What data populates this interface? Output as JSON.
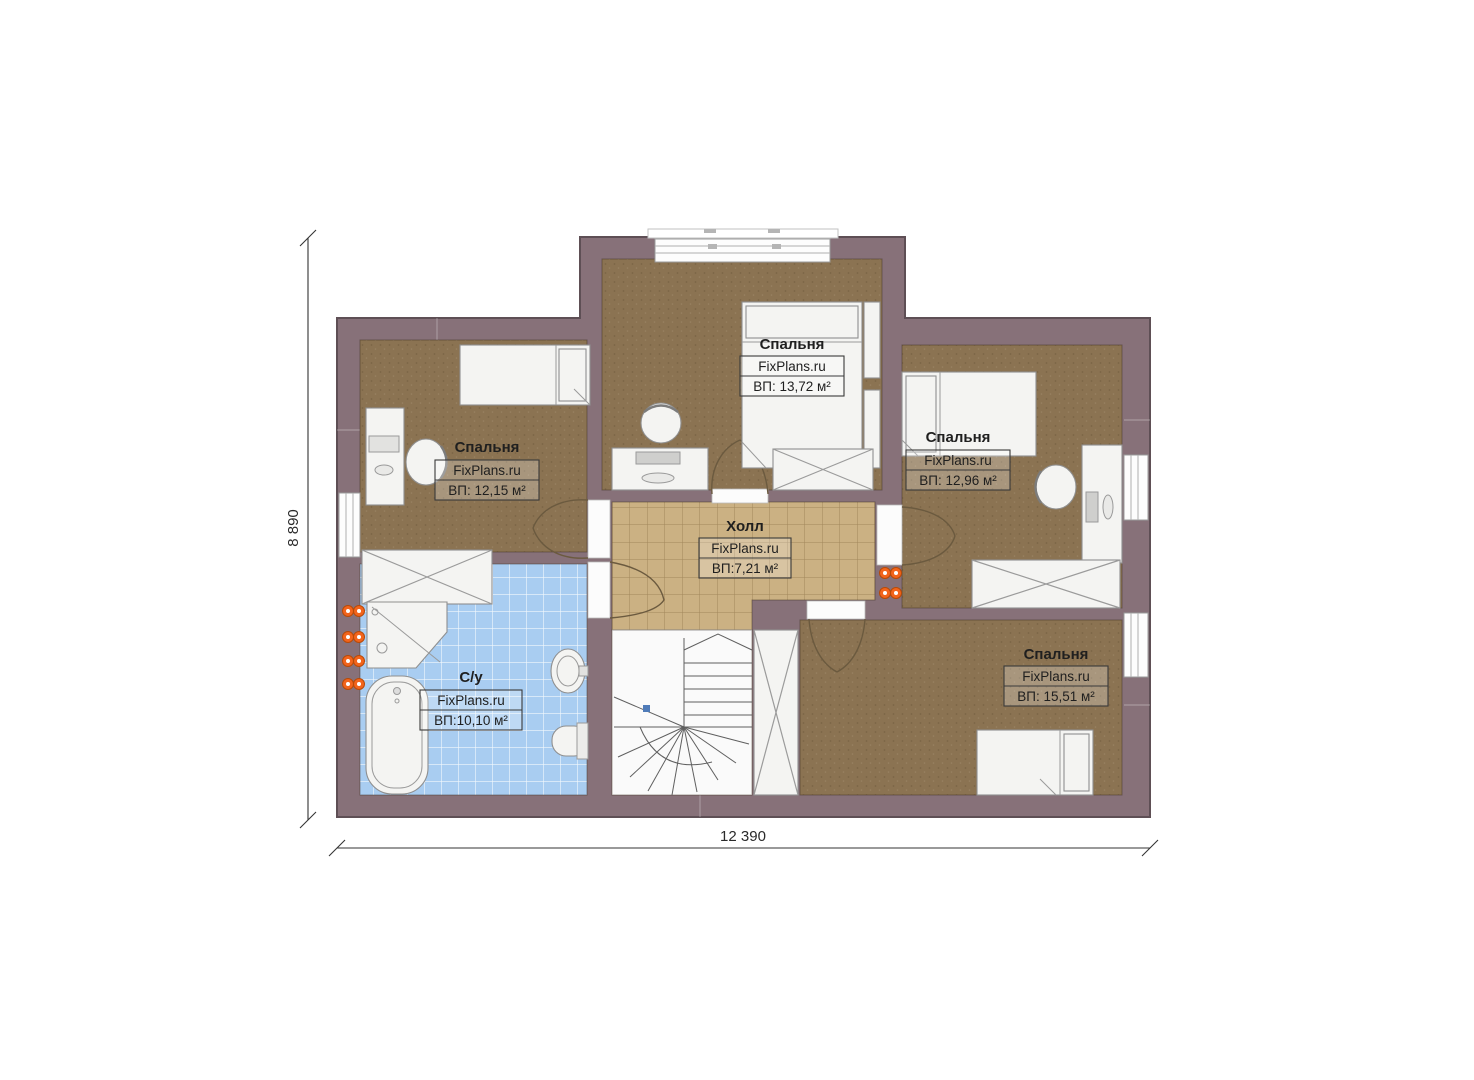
{
  "plan": {
    "type": "floor-plan",
    "brand": "FixPlans.ru",
    "rooms": [
      {
        "id": "bedroom-top",
        "name": "Спальня",
        "brand": "FixPlans.ru",
        "area": "ВП: 13,72 м²"
      },
      {
        "id": "bedroom-left",
        "name": "Спальня",
        "brand": "FixPlans.ru",
        "area": "ВП: 12,15 м²"
      },
      {
        "id": "bedroom-right",
        "name": "Спальня",
        "brand": "FixPlans.ru",
        "area": "ВП: 12,96 м²"
      },
      {
        "id": "hall",
        "name": "Холл",
        "brand": "FixPlans.ru",
        "area": "ВП:7,21 м²"
      },
      {
        "id": "bathroom",
        "name": "С/у",
        "brand": "FixPlans.ru",
        "area": "ВП:10,10 м²"
      },
      {
        "id": "bedroom-bottom",
        "name": "Спальня",
        "brand": "FixPlans.ru",
        "area": "ВП: 15,51 м²"
      }
    ],
    "dimensions": {
      "width_label": "12 390",
      "height_label": "8 890"
    },
    "colors": {
      "wall": "#877179",
      "wall_outline": "#5e4f55",
      "bedroom_floor": "#8b7352",
      "hall_floor": "#cbb183",
      "hall_grid": "#a3875f",
      "bath_floor": "#a9cdf1",
      "bath_grid": "#ffffff",
      "furniture": "#f4f4f2",
      "radiator": "#f2641c",
      "dimension_line": "#333333",
      "text": "#1f1f1f"
    }
  }
}
